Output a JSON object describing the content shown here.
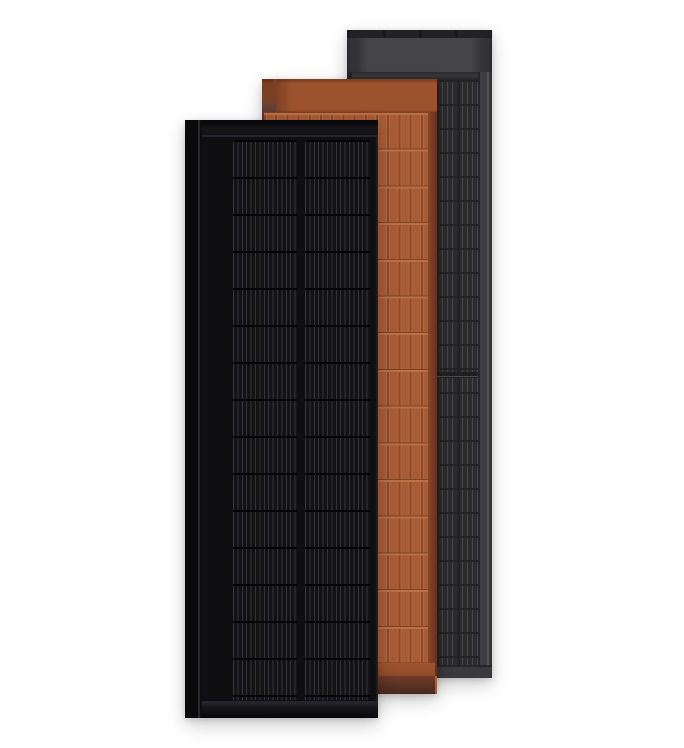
{
  "scene": {
    "description": "Product render of three overlapping tall vertical solar roof panels standing on a white background",
    "panels": [
      {
        "name": "black solar panel",
        "position": "front left",
        "finish_color": "#0f0f12"
      },
      {
        "name": "terracotta solar panel",
        "position": "middle",
        "finish_color": "#a75c36"
      },
      {
        "name": "gray solar panel",
        "position": "back right",
        "finish_color": "#2c2c2f"
      }
    ]
  },
  "colors": {
    "bg": "#ffffff",
    "black_strip": "#0a0a0b",
    "black_strip_hl": "#28282c",
    "black_face": "#0f0f12",
    "black_rail_hl": "#24242a",
    "black_cell": "#131316",
    "black_busbar": "#34343a",
    "black_sep": "#050507",
    "terra_header": "#9b522d",
    "terra_header_dark": "#7e4124",
    "terra_seam": "#7a4128",
    "terra_tab_top": "#6a4136",
    "terra_tab_bot": "#54322b",
    "terra_body": "#a75c36",
    "terra_gap": "#8a492b",
    "terra_hl": "#b4673e",
    "terra_row": "#7e4225",
    "terra_row_hl": "#b97044",
    "terra_strip": "#9f552f",
    "terra_band_top": "#6e3b2c",
    "terra_band_bot": "#48281e",
    "terra_edge_in": "#8a4527",
    "terra_edge": "#5f3220",
    "gray_top": "#222225",
    "gray_tick": "#19191c",
    "gray_header": "#454549",
    "gray_header_edge": "#333336",
    "gray_header_line": "#2c2c2f",
    "gray_body": "#2c2c2f",
    "gray_line": "#47474b",
    "gray_colsep": "#222225",
    "gray_rowsep": "#232326",
    "gray_frame": "#3e3e42",
    "gray_frame_hl": "#525257",
    "gray_divider": "#202023",
    "gray_divider_hl": "#4c4c50",
    "gray_band": "#3a3a3e"
  }
}
